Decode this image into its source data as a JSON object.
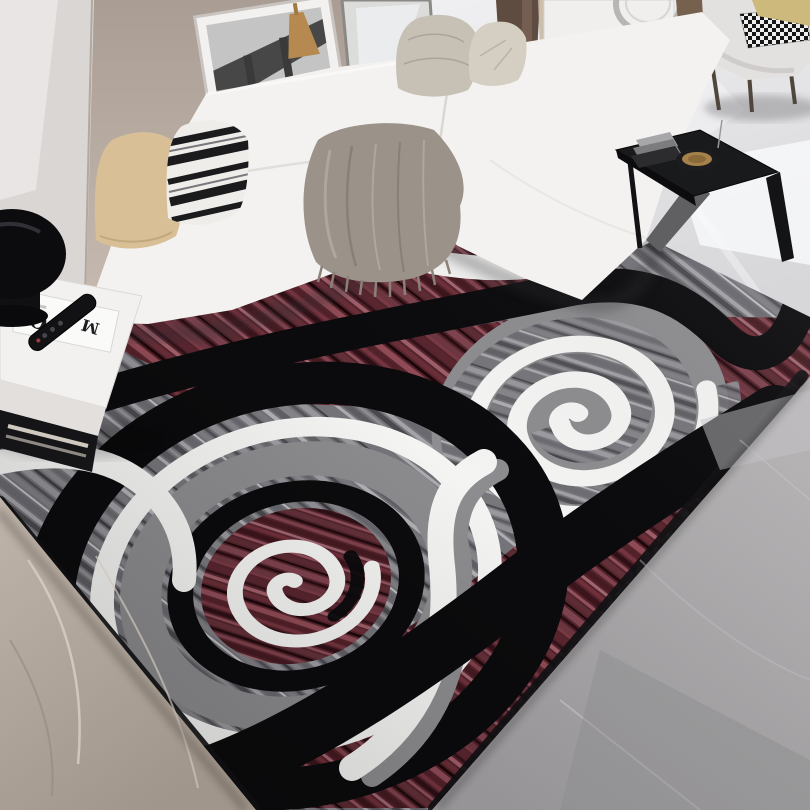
{
  "meta": {
    "type": "natural-photo",
    "subject": "Top-down photo of a black, white, gray and burgundy swirl-pattern area rug styled in a modern living room with a white sectional sofa and marble floors",
    "canvas": {
      "width": 810,
      "height": 810
    }
  },
  "rug": {
    "pattern": "abstract spiral swirls with S-curve bands",
    "motifs": [
      "large double swirl lower-left",
      "medium white spiral upper-right",
      "black S-curve band across middle",
      "white accent bands",
      "streaked heathered texture"
    ],
    "colors": {
      "black": "#0b0b0d",
      "white": "#f4f4f3",
      "streak_gray": "#737378",
      "smooth_gray": "#8c8c8f",
      "burgundy": "#53242c"
    }
  },
  "room": {
    "wall_color": "#b9ada4",
    "floors": {
      "top_right": "polished light marble",
      "bottom_left": "beige marble",
      "bottom_right": "gray stone marble"
    },
    "furniture": [
      "white L-shaped sectional sofa",
      "white square side table",
      "black dome stool lamp",
      "black C-shaped side table",
      "light armchair with metal legs",
      "white cabinet with round door",
      "wall shelf with books and figurine"
    ]
  },
  "decor": {
    "magazine_letter_1": "O",
    "magazine_letter_2": "M",
    "art": "Paris bridge and Eiffel Tower framed print",
    "pillows": [
      "beige",
      "black-white striped",
      "gray knit",
      "houndstooth",
      "yellow"
    ],
    "items_on_side_table": [
      "magazine",
      "tv remote"
    ],
    "items_on_c_table": [
      "gray book stack",
      "round brass tray"
    ],
    "throw_blanket_color": "#9b9289"
  },
  "palette": {
    "sofa_white": "#f3f2f0",
    "marble_top": "#ececee",
    "marble_beige": "#b2a79c",
    "marble_gray": "#a5a4a7",
    "blanket_taupe": "#9b9289",
    "pillow_beige": "#d8bf95",
    "pillow_yellow": "#cdb97c",
    "curtain_brown": "#5f4c40",
    "tray_brass": "#a5824a"
  }
}
